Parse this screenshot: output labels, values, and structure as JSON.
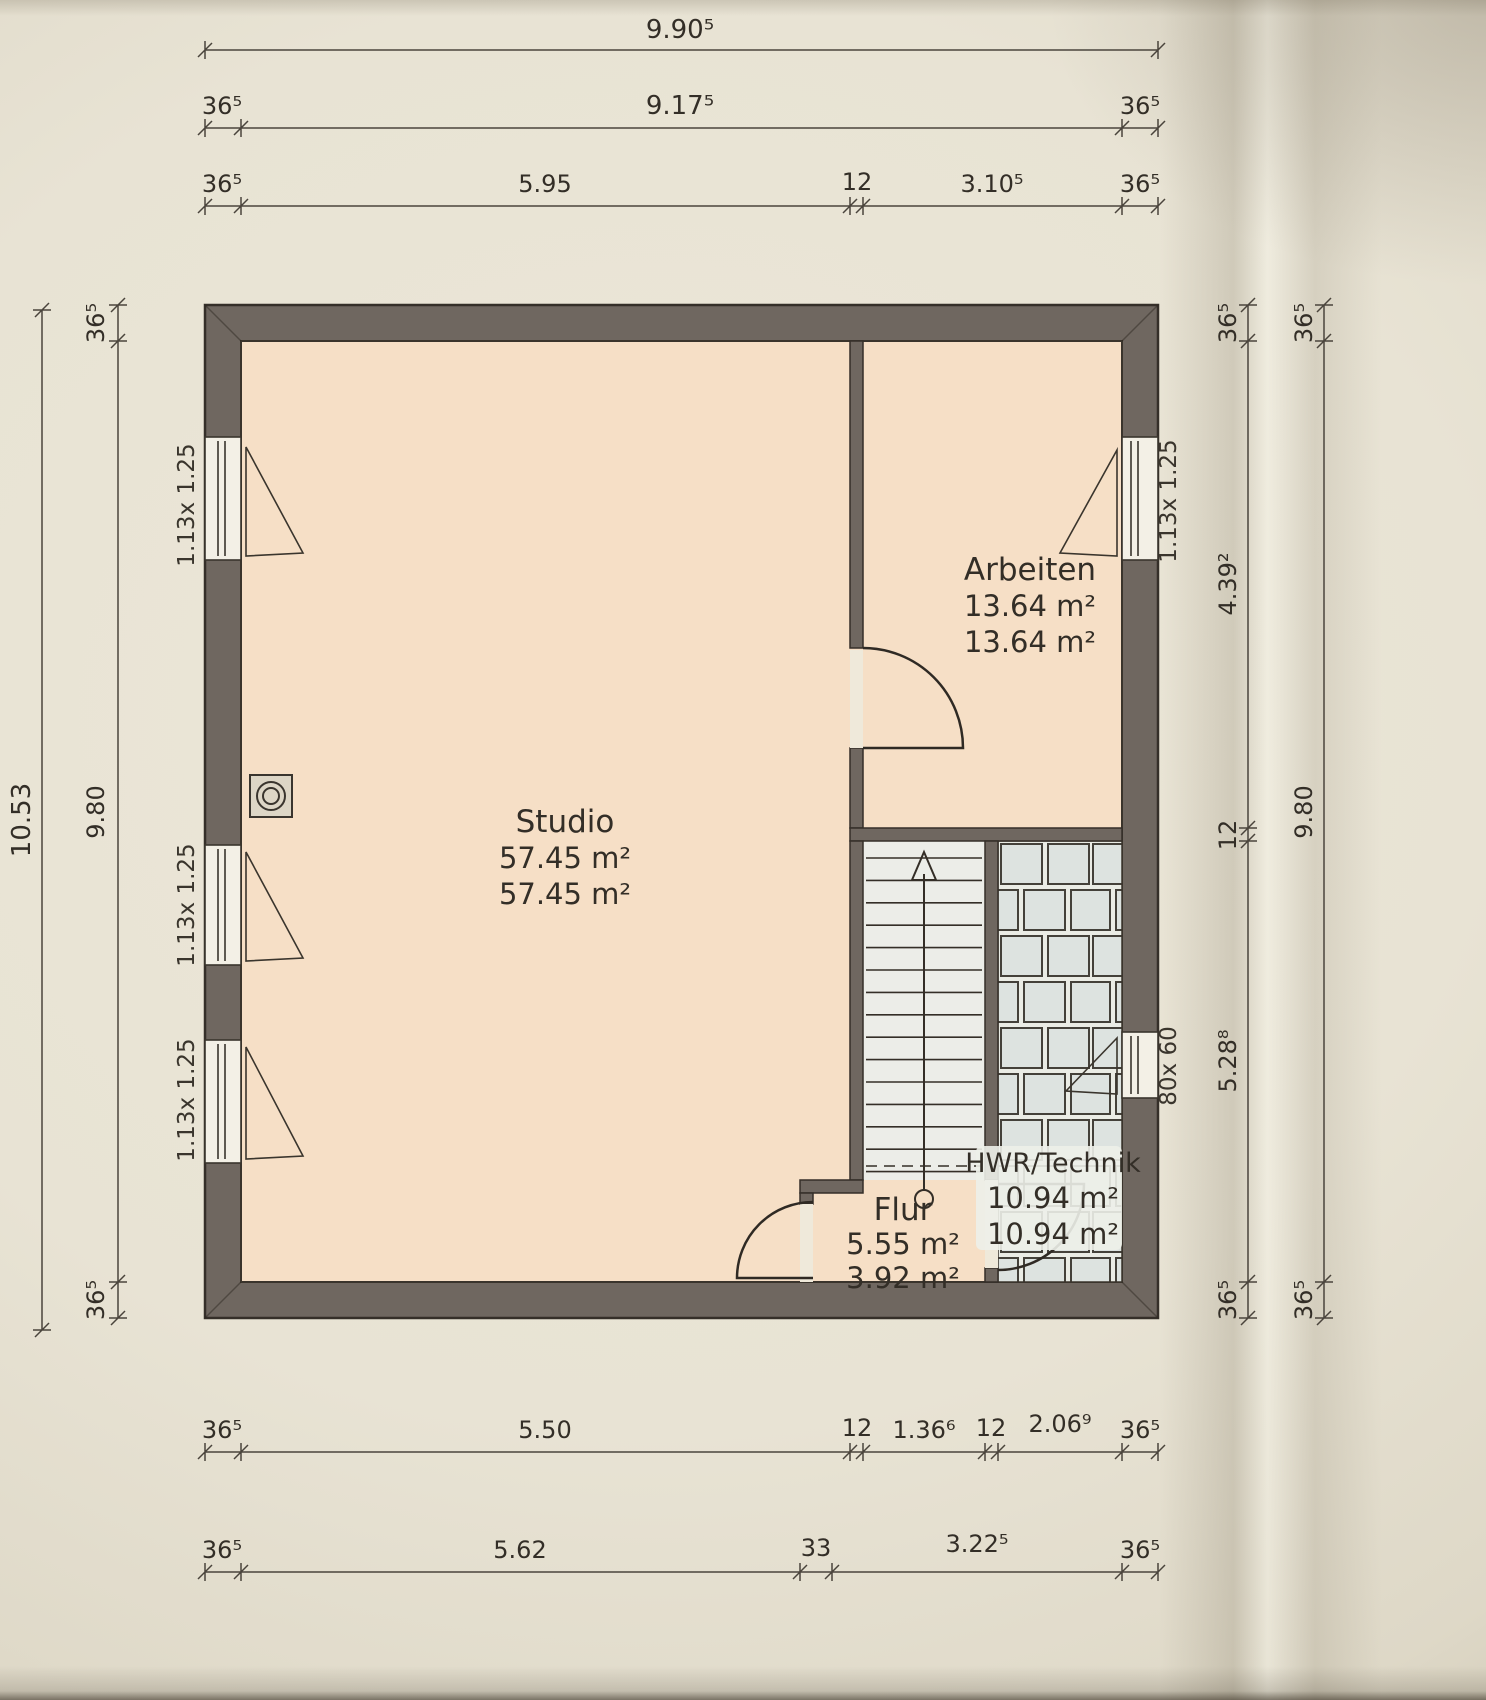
{
  "plan": {
    "title_hint": "floor plan scan",
    "rooms": {
      "studio": {
        "name": "Studio",
        "area_line1": "57.45 m²",
        "area_line2": "57.45 m²"
      },
      "arbeiten": {
        "name": "Arbeiten",
        "area_line1": "13.64 m²",
        "area_line2": "13.64 m²"
      },
      "flur": {
        "name": "Flur",
        "area_line1": "5.55 m²",
        "area_line2": "3.92 m²"
      },
      "hwr_technik": {
        "name": "HWR/Technik",
        "area_line1": "10.94 m²",
        "area_line2": "10.94 m²"
      }
    },
    "windows": {
      "left_1": "1.13x 1.25",
      "left_2": "1.13x 1.25",
      "left_3": "1.13x 1.25",
      "arbeiten_right": "1.13x 1.25",
      "hwr_right": "80x 60"
    },
    "dimensions": {
      "top_row_1_total": "9.90⁵",
      "top_row_2": [
        "36⁵",
        "9.17⁵",
        "36⁵"
      ],
      "top_row_3": [
        "36⁵",
        "5.95",
        "12",
        "3.10⁵",
        "36⁵"
      ],
      "left_col_outer_total": "10.53",
      "left_col_inner": [
        "36⁵",
        "9.80",
        "36⁵"
      ],
      "right_col_inner": [
        "36⁵",
        "4.39²",
        "12",
        "5.28⁸",
        "36⁵"
      ],
      "right_col_outer": [
        "36⁵",
        "9.80",
        "36⁵"
      ],
      "bottom_row_1": [
        "36⁵",
        "5.50",
        "12",
        "1.36⁶",
        "12",
        "2.06⁹",
        "36⁵"
      ],
      "bottom_row_2": [
        "36⁵",
        "5.62",
        "33",
        "3.22⁵",
        "36⁵"
      ]
    },
    "colors": {
      "wall": "#6f6760",
      "room_floor": "#f6dfc6",
      "stair_floor": "#ecede8",
      "tile_floor": "#dde3e0",
      "paper": "#e8e3d4",
      "line": "#342e27"
    }
  }
}
